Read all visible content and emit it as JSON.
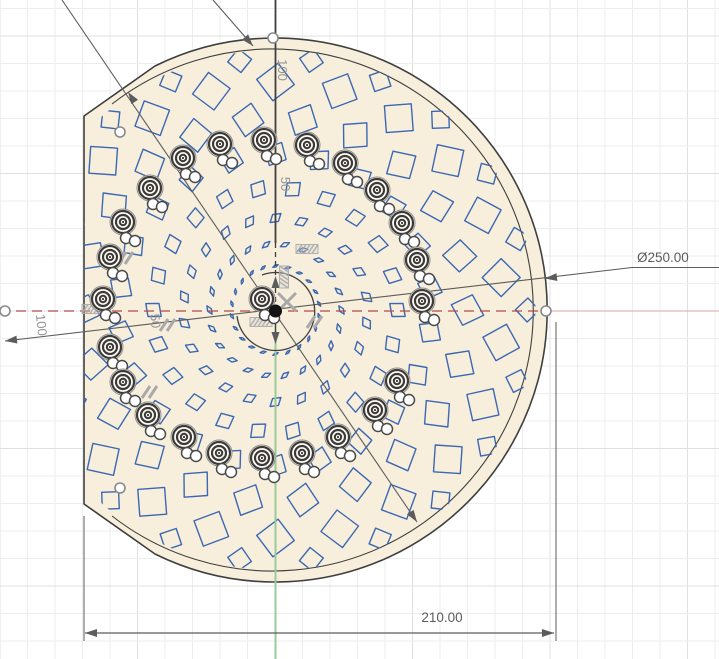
{
  "app": {
    "view": "cad-sketch-canvas"
  },
  "colors": {
    "background": "#ffffff",
    "grid_minor": "#ededed",
    "grid_major": "#e0e0e0",
    "profile_fill": "#f7efdb",
    "outline": "#3f3f3f",
    "sketch_blue": "#3b67b3",
    "axis_red": "#b04a4a",
    "axis_red_pale": "#dda6a6",
    "axis_green": "#98cb98",
    "dim": "#5c5c5c",
    "aux_label": "#949494",
    "glyph": "#a9a9a9",
    "icon_dark": "#3d3935",
    "point_stroke": "#8a8a8a"
  },
  "dimensions": {
    "diameter": {
      "label": "Ø250.00"
    },
    "width": {
      "label": "210.00"
    },
    "aux": [
      {
        "text": "100",
        "axis": "vertical"
      },
      {
        "text": "50",
        "axis": "vertical"
      },
      {
        "text": "100",
        "axis": "horizontal-left"
      },
      {
        "text": "50",
        "axis": "horizontal-left"
      }
    ]
  },
  "sketch": {
    "center": {
      "x": 275.5,
      "y": 310
    },
    "outer_radius": 272,
    "inner_radius": 261,
    "flat_edge_x": 84,
    "profile_path": "M 84,116 L 84,504 L 155,554 A 272,272 0 1 0 155,66 Z",
    "inner_arc_path": "M 112,104 A 261,261 0 1 1 112,516",
    "center_arc_path": "M 262,275 A 39,39 0 1 1 237,316",
    "pattern_rings": [
      {
        "r": 252,
        "n": 22,
        "a": 12,
        "b": 12,
        "tw": 2,
        "off": 0
      },
      {
        "r": 228,
        "n": 22,
        "a": 19,
        "b": 19,
        "tw": 8,
        "off": 0.5
      },
      {
        "r": 192,
        "n": 22,
        "a": 17,
        "b": 16,
        "tw": 18,
        "off": 0
      },
      {
        "r": 156,
        "n": 22,
        "a": 13,
        "b": 12,
        "tw": 28,
        "off": 0.5
      },
      {
        "r": 122,
        "n": 22,
        "a": 10,
        "b": 8.5,
        "tw": 40,
        "off": 0
      },
      {
        "r": 92,
        "n": 22,
        "a": 7,
        "b": 4.5,
        "tw": 50,
        "off": 0.5
      },
      {
        "r": 66,
        "n": 22,
        "a": 5,
        "b": 2.2,
        "tw": 58,
        "off": 0
      },
      {
        "r": 44,
        "n": 22,
        "a": 3,
        "b": 1.1,
        "tw": 64,
        "off": 0.5
      }
    ],
    "hole_icons": [
      [
        110,
        257
      ],
      [
        123,
        222
      ],
      [
        150,
        188
      ],
      [
        183,
        158
      ],
      [
        220,
        144
      ],
      [
        264,
        140
      ],
      [
        307,
        145
      ],
      [
        345,
        163
      ],
      [
        377,
        190
      ],
      [
        402,
        223
      ],
      [
        417,
        260
      ],
      [
        422,
        301
      ],
      [
        103,
        299
      ],
      [
        110,
        347
      ],
      [
        123,
        382
      ],
      [
        148,
        415
      ],
      [
        184,
        437
      ],
      [
        219,
        453
      ],
      [
        262,
        458
      ],
      [
        302,
        453
      ],
      [
        338,
        437
      ],
      [
        375,
        410
      ],
      [
        397,
        381
      ],
      [
        262,
        299
      ]
    ],
    "white_point_offsets": [
      [
        3,
        16
      ],
      [
        12,
        19
      ]
    ],
    "sketch_points": [
      [
        273,
        38
      ],
      [
        546,
        311
      ],
      [
        5,
        311
      ],
      [
        120,
        132
      ],
      [
        120,
        488
      ]
    ],
    "constraint_hatches": [
      {
        "x": 284,
        "y": 277,
        "rot": 90
      },
      {
        "x": 261,
        "y": 322,
        "rot": 0
      },
      {
        "x": 307,
        "y": 249,
        "rot": 0
      },
      {
        "x": 93,
        "y": 309,
        "rot": 0
      }
    ],
    "constraint_slashes": [
      {
        "x": 315,
        "y": 322
      },
      {
        "x": 168,
        "y": 325
      },
      {
        "x": 126,
        "y": 258
      },
      {
        "x": 150,
        "y": 392
      }
    ],
    "constraint_crosses": [
      {
        "x": 287,
        "y": 302
      }
    ],
    "lines": {
      "inner_dia_line": {
        "x1": 62,
        "y1": 0,
        "x2": 417,
        "y2": 522
      },
      "top_leader": {
        "x1": 213,
        "y1": 0,
        "x2": 253,
        "y2": 46
      },
      "dia_leader": {
        "x1": 5,
        "y1": 341,
        "x2": 632,
        "y2": 267.5
      },
      "dia_leader_tail": {
        "x1": 632,
        "y1": 267.5,
        "x2": 719,
        "y2": 267.5
      },
      "width_dim": {
        "x1": 85,
        "y1": 633,
        "x2": 554,
        "y2": 633
      },
      "width_ext_left": {
        "x1": 84,
        "y1": 516,
        "x2": 84,
        "y2": 641
      },
      "width_ext_right": {
        "x1": 556,
        "y1": 322,
        "x2": 556,
        "y2": 641
      },
      "v_solid_top": {
        "x1": 275.5,
        "y1": 0,
        "x2": 275.5,
        "y2": 243
      },
      "v_dashed": {
        "x1": 275.5,
        "y1": 243,
        "x2": 275.5,
        "y2": 309
      },
      "v_below": {
        "x1": 275.5,
        "y1": 311,
        "x2": 275.5,
        "y2": 341
      }
    },
    "arrows": [
      {
        "x": 545,
        "y": 278.5,
        "a": 173
      },
      {
        "x": 5,
        "y": 341,
        "a": 173
      },
      {
        "x": 128,
        "y": 92,
        "a": 236
      },
      {
        "x": 417,
        "y": 522,
        "a": 56
      },
      {
        "x": 253,
        "y": 46,
        "a": 49
      },
      {
        "x": 85,
        "y": 633,
        "a": 180
      },
      {
        "x": 554,
        "y": 633,
        "a": 0
      },
      {
        "x": 275.5,
        "y": 276,
        "a": -90
      },
      {
        "x": 275.5,
        "y": 344,
        "a": 90
      }
    ],
    "grid": {
      "spacing": 27.5,
      "y_offset": 8.5,
      "major_every_px": 137.5,
      "y_major_anchor": 36
    }
  }
}
